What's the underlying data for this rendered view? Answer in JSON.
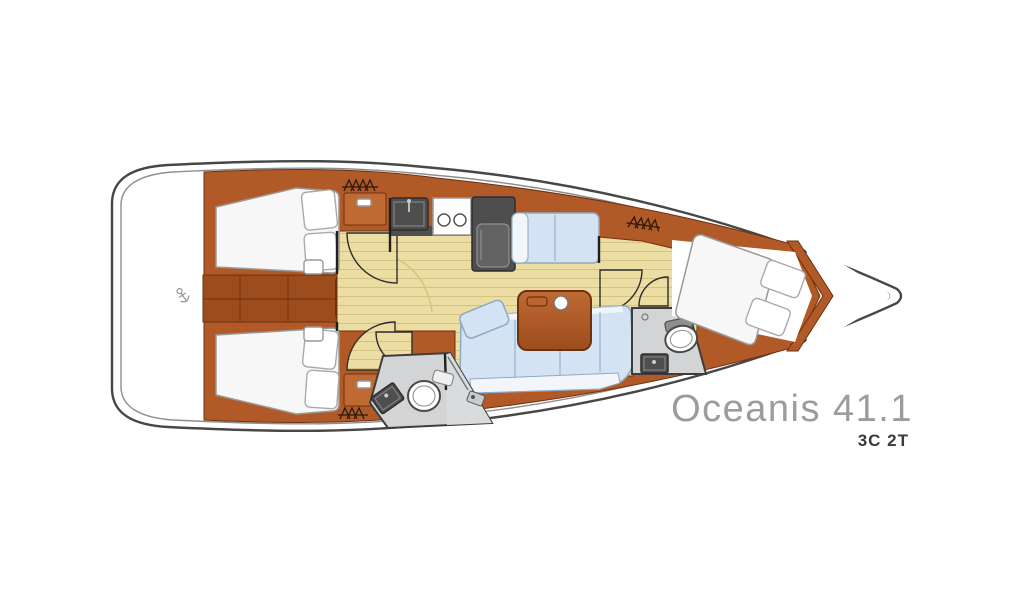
{
  "boat": {
    "model": "Oceanis 41.1",
    "variant": "3C 2T"
  },
  "colors": {
    "background": "#ffffff",
    "hull_outline": "#474747",
    "hull_inner": "#8e8e8e",
    "wood": "#b15a27",
    "wood_dark": "#9c4c1d",
    "wood_light": "#c06a33",
    "wood_seam": "#6e3110",
    "floor": "#ecdda2",
    "floor_line": "#d6c184",
    "bed": "#f7f7f7",
    "bed_stroke": "#9a9a9a",
    "sofa": "#d4e3f3",
    "sofa_stroke": "#8ea9c2",
    "sofa_front": "#f2f6fa",
    "head_floor": "#d2d4d6",
    "head_stroke": "#3d3d3d",
    "appliance": "#4e4e4e",
    "appliance_light": "#636363",
    "door_arc": "#2f2f2f",
    "icon_dark": "#2b1a0d",
    "title_color": "#9c9c9c",
    "subtitle_color": "#3a3a3a"
  }
}
